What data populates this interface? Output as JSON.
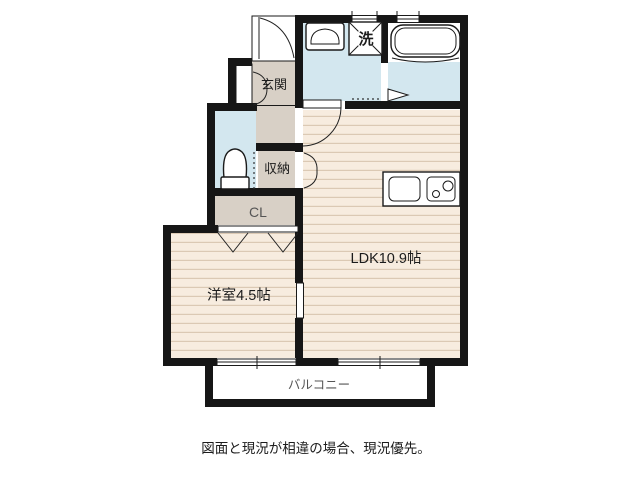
{
  "floorplan": {
    "rooms": {
      "entrance": {
        "label": "玄関"
      },
      "washing_machine": {
        "label": "洗"
      },
      "storage": {
        "label": "収納"
      },
      "closet": {
        "label": "CL"
      },
      "ldk": {
        "label": "LDK10.9帖"
      },
      "western_room": {
        "label": "洋室4.5帖"
      },
      "balcony": {
        "label": "バルコニー"
      }
    },
    "caption": "図面と現況が相違の場合、現況優先。",
    "palette": {
      "wall": "#161616",
      "water_floor": "#d3e7ef",
      "hall_floor": "#d8d0c6",
      "wood_floor": "#f7ecdf",
      "wood_stripe": "#dbc9b4",
      "background": "#ffffff",
      "label_gray": "#555555"
    },
    "fixtures": [
      "bathtub",
      "washbasin",
      "washing-machine",
      "toilet",
      "kitchen-sink",
      "stove-burners",
      "sliding-window",
      "door-swing",
      "folding-door",
      "closet-door"
    ]
  }
}
